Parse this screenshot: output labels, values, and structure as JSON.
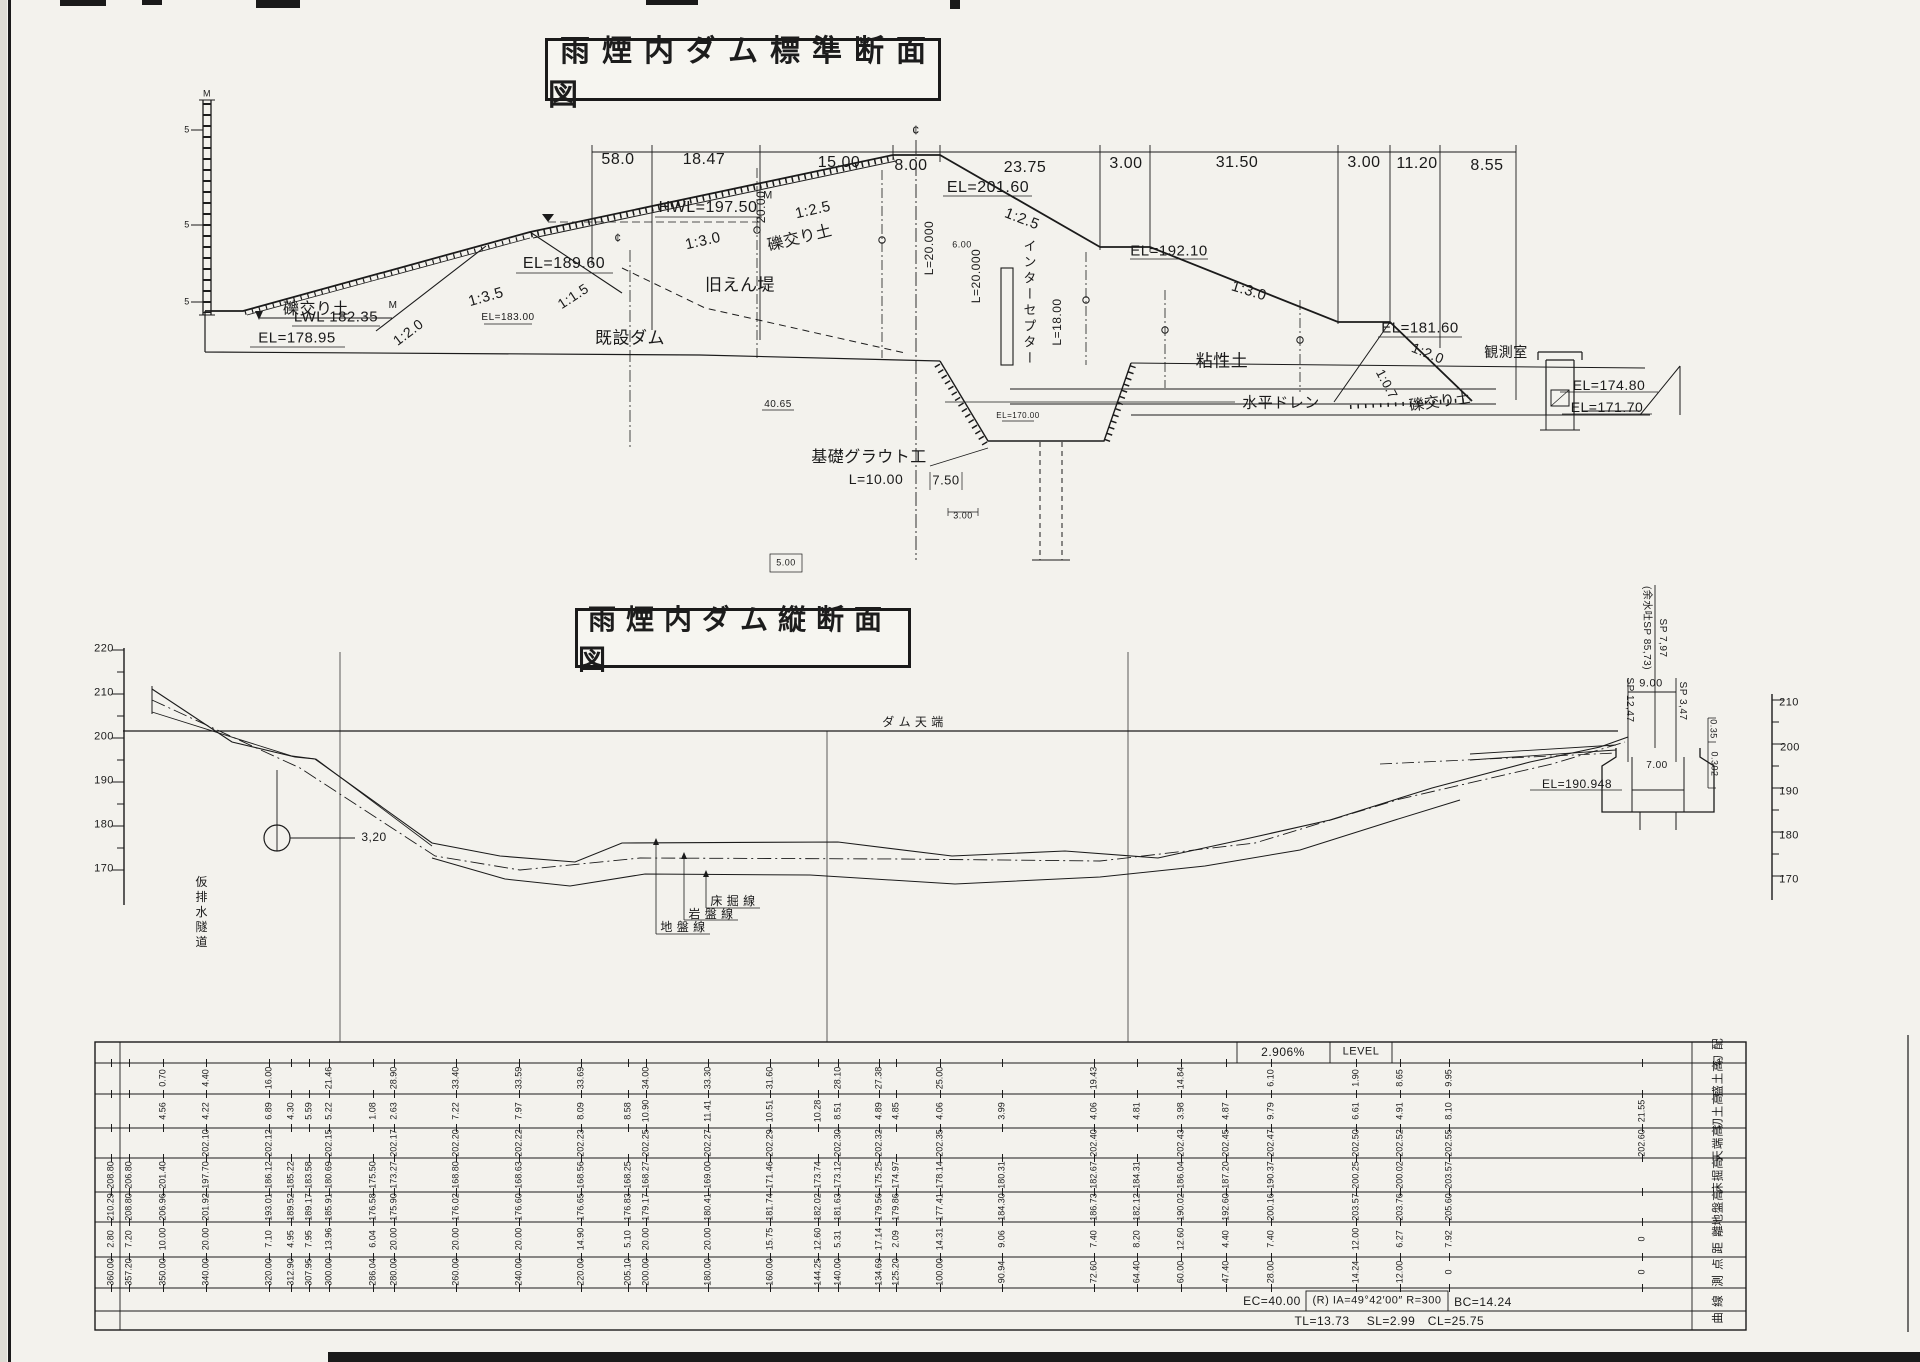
{
  "titles": {
    "standard": "雨煙内ダム標準断面図",
    "longitudinal": "雨煙内ダム縦断面図"
  },
  "annotations": [
    {
      "n": "dim-58",
      "t": "58.0",
      "x": 618,
      "y": 160,
      "fs": 16
    },
    {
      "n": "dim-18-47",
      "t": "18.47",
      "x": 704,
      "y": 160,
      "fs": 16
    },
    {
      "n": "dim-15-00",
      "t": "15.00",
      "x": 839,
      "y": 163,
      "fs": 16
    },
    {
      "n": "dim-8-00",
      "t": "8.00",
      "x": 911,
      "y": 166,
      "fs": 16
    },
    {
      "n": "dim-23-75",
      "t": "23.75",
      "x": 1025,
      "y": 168,
      "fs": 16
    },
    {
      "n": "dim-3-00-a",
      "t": "3.00",
      "x": 1126,
      "y": 164,
      "fs": 16
    },
    {
      "n": "dim-31-50",
      "t": "31.50",
      "x": 1237,
      "y": 163,
      "fs": 16
    },
    {
      "n": "dim-3-00-b",
      "t": "3.00",
      "x": 1364,
      "y": 163,
      "fs": 16
    },
    {
      "n": "dim-11-20",
      "t": "11.20",
      "x": 1417,
      "y": 164,
      "fs": 16
    },
    {
      "n": "dim-8-55",
      "t": "8.55",
      "x": 1487,
      "y": 166,
      "fs": 16
    },
    {
      "n": "lbl-hwl",
      "t": "HWL=197.50",
      "x": 708,
      "y": 208,
      "fs": 16
    },
    {
      "n": "lbl-hwl-m",
      "t": "M",
      "x": 768,
      "y": 196,
      "fs": 11
    },
    {
      "n": "lbl-el-201-60",
      "t": "EL=201.60",
      "x": 988,
      "y": 188,
      "fs": 16
    },
    {
      "n": "lbl-el-189-60",
      "t": "EL=189.60",
      "x": 564,
      "y": 264,
      "fs": 16
    },
    {
      "n": "lbl-lwl",
      "t": "LWL 182.35",
      "x": 336,
      "y": 317,
      "fs": 15
    },
    {
      "n": "lbl-lwl-m",
      "t": "M",
      "x": 393,
      "y": 306,
      "fs": 10
    },
    {
      "n": "lbl-el-178-95",
      "t": "EL=178.95",
      "x": 297,
      "y": 338,
      "fs": 15
    },
    {
      "n": "lbl-el-183-00",
      "t": "EL=183.00",
      "x": 508,
      "y": 318,
      "fs": 10
    },
    {
      "n": "lbl-el-192-10",
      "t": "EL=192.10",
      "x": 1169,
      "y": 251,
      "fs": 15
    },
    {
      "n": "lbl-el-181-60",
      "t": "EL=181.60",
      "x": 1420,
      "y": 328,
      "fs": 15
    },
    {
      "n": "lbl-el-174-80",
      "t": "EL=174.80",
      "x": 1609,
      "y": 385,
      "fs": 14
    },
    {
      "n": "lbl-el-171-70",
      "t": "EL=171.70",
      "x": 1607,
      "y": 407,
      "fs": 14
    },
    {
      "n": "lbl-el-170-00",
      "t": "EL=170.00",
      "x": 1018,
      "y": 416,
      "fs": 8
    },
    {
      "n": "slope-1-3-5",
      "t": "1:3.5",
      "x": 486,
      "y": 297,
      "fs": 15,
      "rot": -16
    },
    {
      "n": "slope-1-1-5",
      "t": "1:1.5",
      "x": 573,
      "y": 296,
      "fs": 14,
      "rot": -33
    },
    {
      "n": "slope-1-2-0-a",
      "t": "1:2.0",
      "x": 408,
      "y": 332,
      "fs": 14,
      "rot": -37
    },
    {
      "n": "slope-1-3-0-a",
      "t": "1:3.0",
      "x": 703,
      "y": 241,
      "fs": 15,
      "rot": -13
    },
    {
      "n": "slope-1-2-5-a",
      "t": "1:2.5",
      "x": 813,
      "y": 210,
      "fs": 15,
      "rot": -13
    },
    {
      "n": "slope-1-2-5-b",
      "t": "1:2.5",
      "x": 1022,
      "y": 219,
      "fs": 15,
      "rot": 21
    },
    {
      "n": "slope-1-3-0-b",
      "t": "1:3.0",
      "x": 1249,
      "y": 291,
      "fs": 15,
      "rot": 17
    },
    {
      "n": "slope-1-2-0-b",
      "t": "1:2.0",
      "x": 1428,
      "y": 353,
      "fs": 14,
      "rot": 22
    },
    {
      "n": "slope-1-0-7",
      "t": "1:0.7",
      "x": 1387,
      "y": 384,
      "fs": 13,
      "rot": 62
    },
    {
      "n": "mat-gravel-left",
      "t": "礫交り土",
      "x": 316,
      "y": 310,
      "fs": 16
    },
    {
      "n": "mat-gravel-face",
      "t": "礫交り土",
      "x": 800,
      "y": 239,
      "fs": 16,
      "rot": -14
    },
    {
      "n": "mat-gravel-toe",
      "t": "礫交り土",
      "x": 1440,
      "y": 402,
      "fs": 15,
      "rot": -8
    },
    {
      "n": "lbl-old-embankment",
      "t": "旧えん堤",
      "x": 740,
      "y": 285,
      "fs": 17
    },
    {
      "n": "lbl-existing-dam",
      "t": "既設ダム",
      "x": 630,
      "y": 338,
      "fs": 17
    },
    {
      "n": "lbl-clay",
      "t": "粘性土",
      "x": 1222,
      "y": 361,
      "fs": 17
    },
    {
      "n": "lbl-horizontal-drain",
      "t": "水平ドレン",
      "x": 1281,
      "y": 403,
      "fs": 15
    },
    {
      "n": "lbl-observation-room",
      "t": "観測室",
      "x": 1506,
      "y": 352,
      "fs": 14
    },
    {
      "n": "lbl-interceptor",
      "t": "インターセプター",
      "x": 1029,
      "y": 303,
      "fs": 13,
      "v": 1
    },
    {
      "n": "lbl-foundation-grout",
      "t": "基礎グラウト工",
      "x": 869,
      "y": 458,
      "fs": 16
    },
    {
      "n": "lbl-grout-length",
      "t": "L=10.00",
      "x": 876,
      "y": 479,
      "fs": 14
    },
    {
      "n": "dim-7-50",
      "t": "7.50",
      "x": 946,
      "y": 480,
      "fs": 13
    },
    {
      "n": "dim-40-65",
      "t": "40.65",
      "x": 778,
      "y": 405,
      "fs": 10
    },
    {
      "n": "dim-20-00-v",
      "t": "20.00",
      "x": 761,
      "y": 207,
      "fs": 12,
      "rot": -90
    },
    {
      "n": "dim-l-20-000-a",
      "t": "L=20.000",
      "x": 929,
      "y": 248,
      "fs": 12,
      "rot": -90
    },
    {
      "n": "dim-l-20-000-b",
      "t": "L=20.000",
      "x": 976,
      "y": 276,
      "fs": 12,
      "rot": -90
    },
    {
      "n": "dim-l-18-00",
      "t": "L=18.00",
      "x": 1057,
      "y": 322,
      "fs": 12,
      "rot": -90
    },
    {
      "n": "dim-6-00",
      "t": "6.00",
      "x": 962,
      "y": 245,
      "fs": 9
    },
    {
      "n": "dim-3-00-c",
      "t": "3.00",
      "x": 963,
      "y": 516,
      "fs": 9
    },
    {
      "n": "dim-5-00",
      "t": "5.00",
      "x": 786,
      "y": 563,
      "fs": 9
    },
    {
      "n": "scale-m-top",
      "t": "M",
      "x": 207,
      "y": 94,
      "fs": 9
    },
    {
      "n": "scale-5-a",
      "t": "5",
      "x": 187,
      "y": 130,
      "fs": 9
    },
    {
      "n": "scale-5-b",
      "t": "5",
      "x": 187,
      "y": 225,
      "fs": 9
    },
    {
      "n": "scale-5-c",
      "t": "5",
      "x": 187,
      "y": 302,
      "fs": 9
    },
    {
      "n": "cl-mark-main",
      "t": "¢",
      "x": 916,
      "y": 130,
      "fs": 13
    },
    {
      "n": "cl-mark-existing",
      "t": "¢",
      "x": 618,
      "y": 238,
      "fs": 12
    },
    {
      "n": "axisL-220",
      "t": "220",
      "x": 104,
      "y": 649,
      "fs": 11
    },
    {
      "n": "axisL-210",
      "t": "210",
      "x": 104,
      "y": 693,
      "fs": 11
    },
    {
      "n": "axisL-200",
      "t": "200",
      "x": 104,
      "y": 737,
      "fs": 11
    },
    {
      "n": "axisL-190",
      "t": "190",
      "x": 104,
      "y": 781,
      "fs": 11
    },
    {
      "n": "axisL-180",
      "t": "180",
      "x": 104,
      "y": 825,
      "fs": 11
    },
    {
      "n": "axisL-170",
      "t": "170",
      "x": 104,
      "y": 869,
      "fs": 11
    },
    {
      "n": "axisR-210",
      "t": "210",
      "x": 1789,
      "y": 703,
      "fs": 11
    },
    {
      "n": "axisR-200",
      "t": "200",
      "x": 1790,
      "y": 748,
      "fs": 11
    },
    {
      "n": "axisR-190",
      "t": "190",
      "x": 1789,
      "y": 792,
      "fs": 11
    },
    {
      "n": "axisR-180",
      "t": "180",
      "x": 1789,
      "y": 836,
      "fs": 11
    },
    {
      "n": "axisR-170",
      "t": "170",
      "x": 1789,
      "y": 880,
      "fs": 11
    },
    {
      "n": "lbl-dam-crest",
      "t": "ダ ム 天 端",
      "x": 913,
      "y": 722,
      "fs": 12
    },
    {
      "n": "dim-3-20",
      "t": "3,20",
      "x": 374,
      "y": 837,
      "fs": 12
    },
    {
      "n": "lbl-diversion-tunnel",
      "t": "仮排水隧道",
      "x": 201,
      "y": 913,
      "fs": 12,
      "v": 1
    },
    {
      "n": "lbl-excavation-line",
      "t": "床 掘 線",
      "x": 733,
      "y": 901,
      "fs": 12
    },
    {
      "n": "lbl-rock-line",
      "t": "岩 盤 線",
      "x": 711,
      "y": 914,
      "fs": 12
    },
    {
      "n": "lbl-ground-line",
      "t": "地 盤 線",
      "x": 683,
      "y": 927,
      "fs": 12
    },
    {
      "n": "lbl-el-190-948",
      "t": "EL=190.948",
      "x": 1577,
      "y": 784,
      "fs": 12
    },
    {
      "n": "lbl-spillway-sp",
      "t": "(余水吐SP 85,73)",
      "x": 1646,
      "y": 628,
      "fs": 10,
      "rot": 90
    },
    {
      "n": "lbl-sp-7-97",
      "t": "SP 7,97",
      "x": 1662,
      "y": 638,
      "fs": 10,
      "rot": 90
    },
    {
      "n": "lbl-sp-12-47",
      "t": "SP 12,47",
      "x": 1629,
      "y": 700,
      "fs": 10,
      "rot": 90
    },
    {
      "n": "lbl-sp-3-47",
      "t": "SP 3,47",
      "x": 1682,
      "y": 701,
      "fs": 10,
      "rot": 90
    },
    {
      "n": "dim-9-00",
      "t": "9.00",
      "x": 1651,
      "y": 684,
      "fs": 11
    },
    {
      "n": "dim-0-35",
      "t": "0.35",
      "x": 1713,
      "y": 729,
      "fs": 9,
      "rot": 90
    },
    {
      "n": "dim-0-302",
      "t": "0.302",
      "x": 1714,
      "y": 764,
      "fs": 9,
      "rot": 90
    },
    {
      "n": "dim-7-00",
      "t": "7.00",
      "x": 1657,
      "y": 766,
      "fs": 10
    },
    {
      "n": "tbl-gradient",
      "t": "2.906%",
      "x": 1283,
      "y": 1052,
      "fs": 12
    },
    {
      "n": "tbl-level",
      "t": "LEVEL",
      "x": 1361,
      "y": 1052,
      "fs": 11
    },
    {
      "n": "curve-ec",
      "t": "EC=40.00",
      "x": 1272,
      "y": 1301,
      "fs": 12
    },
    {
      "n": "curve-ia",
      "t": "(R) IA=49°42′00″ R=300",
      "x": 1377,
      "y": 1301,
      "fs": 11
    },
    {
      "n": "curve-bc",
      "t": "BC=14.24",
      "x": 1483,
      "y": 1302,
      "fs": 12
    },
    {
      "n": "curve-tl",
      "t": "TL=13.73",
      "x": 1322,
      "y": 1321,
      "fs": 12
    },
    {
      "n": "curve-sl",
      "t": "SL=2.99",
      "x": 1391,
      "y": 1321,
      "fs": 12
    },
    {
      "n": "curve-cl",
      "t": "CL=25.75",
      "x": 1456,
      "y": 1321,
      "fs": 12
    }
  ],
  "table": {
    "row_labels": [
      "勾 配",
      "盛土高",
      "切土高",
      "天端高",
      "床掘高",
      "地盤高",
      "距 離",
      "測 点",
      "曲 線"
    ],
    "columns": [
      {
        "x": 111,
        "v": [
          "",
          "",
          "",
          "208.80",
          "210.29",
          "2.80",
          "360.00"
        ]
      },
      {
        "x": 129,
        "v": [
          "",
          "",
          "",
          "206.80",
          "208.80",
          "7.20",
          "357.20"
        ]
      },
      {
        "x": 163,
        "v": [
          "0.70",
          "4.56",
          "",
          "201.40",
          "206.96",
          "10.00",
          "350.00"
        ]
      },
      {
        "x": 206,
        "v": [
          "4.40",
          "4.22",
          "202.10",
          "197.70",
          "201.92",
          "20.00",
          "340.00"
        ]
      },
      {
        "x": 269,
        "v": [
          "16.00",
          "6.89",
          "202.12",
          "186.12",
          "193.01",
          "7.10",
          "320.00"
        ]
      },
      {
        "x": 291,
        "v": [
          "",
          "4.30",
          "",
          "185.22",
          "189.52",
          "4.95",
          "312.90"
        ]
      },
      {
        "x": 309,
        "v": [
          "",
          "5.59",
          "",
          "183.58",
          "189.17",
          "7.95",
          "307.95"
        ]
      },
      {
        "x": 329,
        "v": [
          "21.46",
          "5.22",
          "202.15",
          "180.69",
          "185.91",
          "13.96",
          "300.00"
        ]
      },
      {
        "x": 373,
        "v": [
          "",
          "1.08",
          "",
          "175.50",
          "176.58",
          "6.04",
          "286.04"
        ]
      },
      {
        "x": 394,
        "v": [
          "28.90",
          "2.63",
          "202.17",
          "173.27",
          "175.90",
          "20.00",
          "280.00"
        ]
      },
      {
        "x": 456,
        "v": [
          "33.40",
          "7.22",
          "202.20",
          "168.80",
          "176.02",
          "20.00",
          "260.00"
        ]
      },
      {
        "x": 519,
        "v": [
          "33.59",
          "7.97",
          "202.22",
          "168.63",
          "176.60",
          "20.00",
          "240.00"
        ]
      },
      {
        "x": 581,
        "v": [
          "33.69",
          "8.09",
          "202.23",
          "168.56",
          "176.65",
          "14.90",
          "220.00"
        ]
      },
      {
        "x": 628,
        "v": [
          "",
          "8.58",
          "",
          "168.25",
          "176.83",
          "5.10",
          "205.10"
        ]
      },
      {
        "x": 646,
        "v": [
          "34.00",
          "10.90",
          "202.25",
          "168.27",
          "179.17",
          "20.00",
          "200.00"
        ]
      },
      {
        "x": 708,
        "v": [
          "33.30",
          "11.41",
          "202.27",
          "169.00",
          "180.41",
          "20.00",
          "180.00"
        ]
      },
      {
        "x": 770,
        "v": [
          "31.60",
          "10.51",
          "202.29",
          "171.46",
          "181.74",
          "15.75",
          "160.00"
        ]
      },
      {
        "x": 818,
        "v": [
          "",
          "10.28",
          "",
          "173.74",
          "182.02",
          "12.60",
          "144.25"
        ]
      },
      {
        "x": 838,
        "v": [
          "28.10",
          "8.51",
          "202.30",
          "173.12",
          "181.63",
          "5.31",
          "140.00"
        ]
      },
      {
        "x": 879,
        "v": [
          "27.38",
          "4.89",
          "202.32",
          "175.25",
          "179.56",
          "17.14",
          "134.69"
        ]
      },
      {
        "x": 896,
        "v": [
          "",
          "4.85",
          "",
          "174.97",
          "179.86",
          "2.09",
          "125.20"
        ]
      },
      {
        "x": 940,
        "v": [
          "25.00",
          "4.06",
          "202.35",
          "178.14",
          "177.41",
          "14.31",
          "100.00"
        ]
      },
      {
        "x": 1002,
        "v": [
          "",
          "3.99",
          "",
          "180.31",
          "184.30",
          "9.06",
          "90.94"
        ]
      },
      {
        "x": 1094,
        "v": [
          "19.43",
          "4.06",
          "202.40",
          "182.67",
          "186.73",
          "7.40",
          "72.60"
        ]
      },
      {
        "x": 1137,
        "v": [
          "",
          "4.81",
          "",
          "184.31",
          "182.12",
          "8.20",
          "64.40"
        ]
      },
      {
        "x": 1181,
        "v": [
          "14.84",
          "3.98",
          "202.43",
          "186.04",
          "190.02",
          "12.60",
          "60.00"
        ]
      },
      {
        "x": 1226,
        "v": [
          "",
          "4.87",
          "202.45",
          "187.20",
          "192.60",
          "4.40",
          "47.40"
        ]
      },
      {
        "x": 1271,
        "v": [
          "6.10",
          "9.79",
          "202.47",
          "190.37",
          "200.16",
          "7.40",
          "28.00"
        ]
      },
      {
        "x": 1356,
        "v": [
          "1.90",
          "6.61",
          "202.50",
          "200.25",
          "203.57",
          "12.00",
          "14.24"
        ]
      },
      {
        "x": 1400,
        "v": [
          "8.65",
          "4.91",
          "202.52",
          "200.02",
          "203.76",
          "6.27",
          "12.00"
        ]
      },
      {
        "x": 1449,
        "v": [
          "9.95",
          "8.10",
          "202.55",
          "203.57",
          "205.60",
          "7.92",
          "0"
        ]
      },
      {
        "x": 1642,
        "v": [
          "",
          "21.55",
          "202.60",
          "",
          "",
          "0",
          "0"
        ]
      }
    ]
  }
}
